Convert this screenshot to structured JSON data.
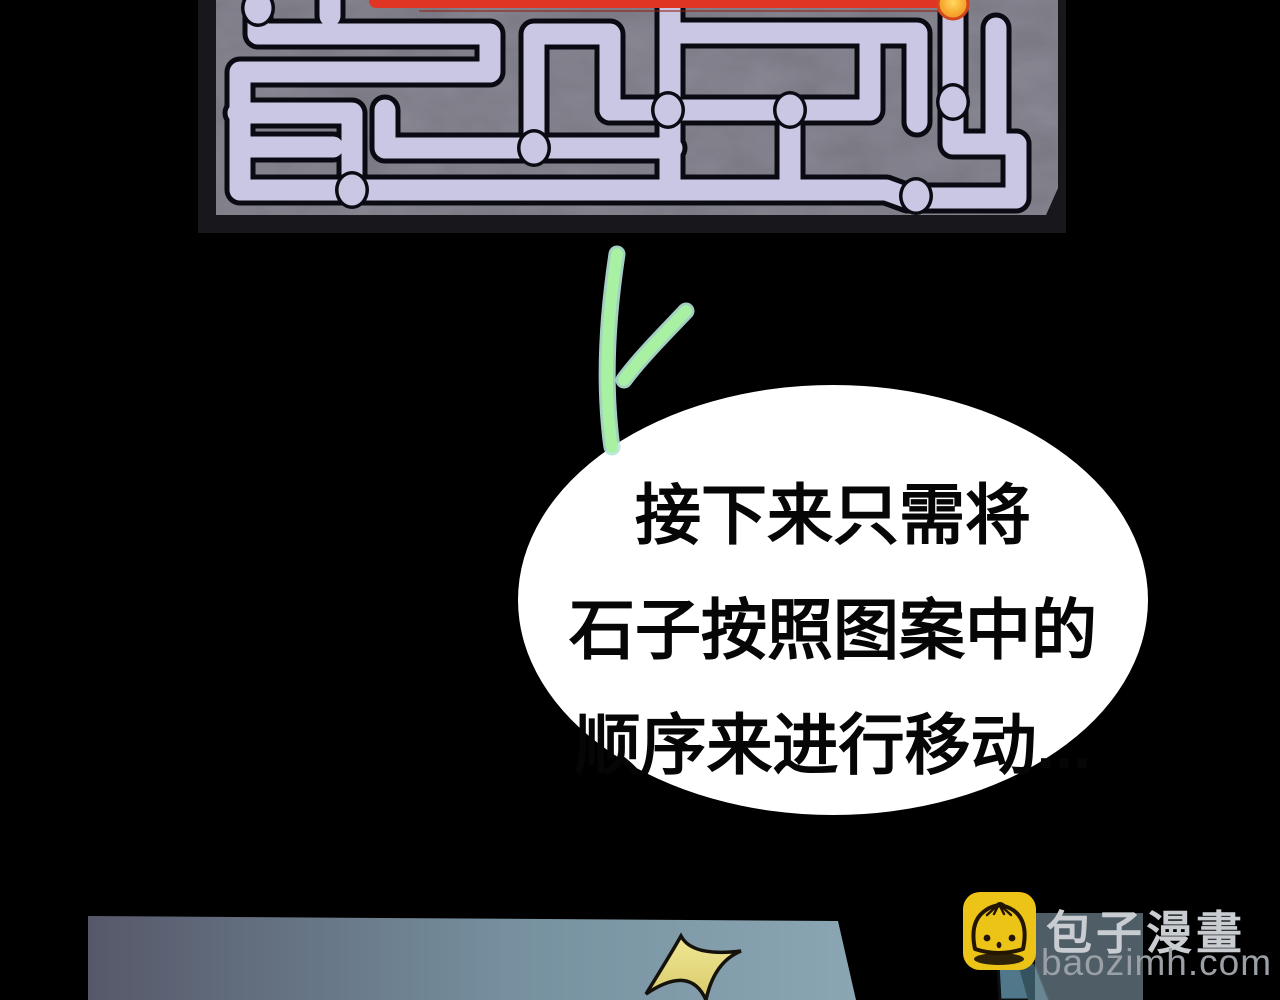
{
  "page": {
    "background": "#000000"
  },
  "tablet": {
    "stone_color": "#8b8992",
    "bevel_color": "#17171c",
    "maze": {
      "path_color": "#c9c7e3",
      "outline_color": "#0a0a12",
      "segments": [
        [
          258,
          -10,
          258,
          34,
          490,
          34,
          490,
          72,
          240,
          72,
          240,
          190,
          352,
          190
        ],
        [
          242,
          147,
          333,
          147
        ],
        [
          238,
          113,
          352,
          113,
          352,
          190
        ],
        [
          330,
          -10,
          330,
          16
        ],
        [
          352,
          190,
          886,
          190,
          908,
          198,
          1016,
          198,
          1016,
          144
        ],
        [
          385,
          110,
          385,
          148,
          534,
          148
        ],
        [
          534,
          148,
          534,
          34,
          610,
          34,
          610,
          110
        ],
        [
          534,
          148,
          672,
          148
        ],
        [
          610,
          110,
          870,
          110,
          870,
          35
        ],
        [
          670,
          -10,
          670,
          190
        ],
        [
          670,
          33,
          917,
          33,
          917,
          122
        ],
        [
          790,
          110,
          790,
          190
        ],
        [
          953,
          -10,
          953,
          102
        ],
        [
          996,
          28,
          996,
          144
        ],
        [
          953,
          102,
          953,
          144,
          1016,
          144
        ]
      ],
      "nodes": [
        [
          258,
          8
        ],
        [
          352,
          190
        ],
        [
          534,
          148
        ],
        [
          668,
          110
        ],
        [
          790,
          110
        ],
        [
          953,
          102
        ],
        [
          916,
          196
        ]
      ],
      "red": {
        "x1": 376,
        "x2": 948,
        "y": 1,
        "width": 14,
        "hairline": [
          420,
          11,
          948,
          11
        ]
      },
      "red_color": "#e03425",
      "red_dark_color": "#8f2012",
      "orange_dot": {
        "cx": 953,
        "cy": 4,
        "r": 15
      },
      "orange_ring_color": "#d3451d"
    }
  },
  "rune": {
    "inner_color": "#a8f1a2",
    "outline_color": "#b5e7d8"
  },
  "speech_bubble": {
    "bubble_color": "#ffffff",
    "text_color": "#060606",
    "line1": "接下来只需将",
    "line2": "石子按照图案中的",
    "line3": "顺序来进行移动..."
  },
  "bottom_panel": {
    "gradient_left": "#565869",
    "gradient_mid": "#76909f",
    "gradient_right": "#8ba6b3"
  },
  "starburst": {
    "fill_top": "#f0e896",
    "fill_bottom": "#d8ca6a",
    "outline": "#14120a"
  },
  "character": {
    "sleeve_light": "#50788a",
    "sleeve_dark": "#37525f"
  },
  "watermark": {
    "site_name": "包子漫畫",
    "site_url": "baozimh.com",
    "logo_color": "#ecc417",
    "logo_line_color": "#231504",
    "backdrop_color": "rgba(156,186,203,0.5)",
    "name_color": "#c9cdd2",
    "url_color": "#9aa0a6"
  }
}
